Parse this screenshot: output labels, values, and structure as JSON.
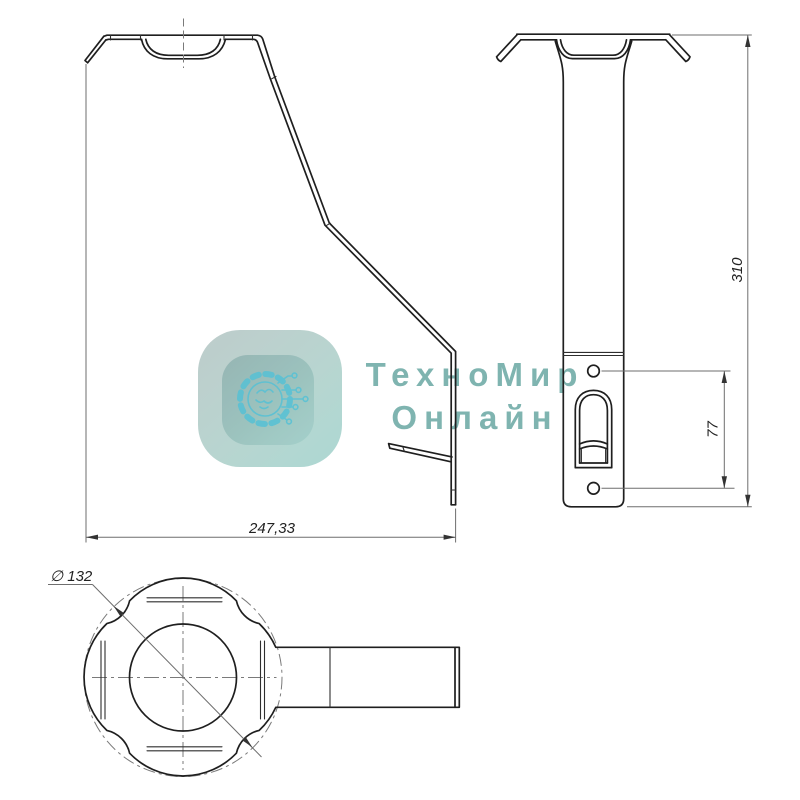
{
  "drawing": {
    "title_hint": "sheet-metal-bracket-三-view-drawing",
    "dimensions": {
      "side_width": "247,33",
      "front_height": "310",
      "front_hole_spacing": "77",
      "bottom_diameter": "∅ 132"
    }
  },
  "watermark": {
    "brand_line1": "ТехноМир",
    "brand_line2": "Онлайн",
    "logo_icon": "gear-circuit-icon"
  },
  "colors": {
    "object_line": "#1f1f1f",
    "thin_line": "#6e6e6e",
    "watermark_text": "#76afab",
    "watermark_icon": "#45bdd4",
    "logo_outer_gradient": [
      "#bac9c8",
      "#a7d6d0"
    ],
    "logo_inner_gradient": [
      "#8fb0ae",
      "#9ecdc7"
    ]
  }
}
